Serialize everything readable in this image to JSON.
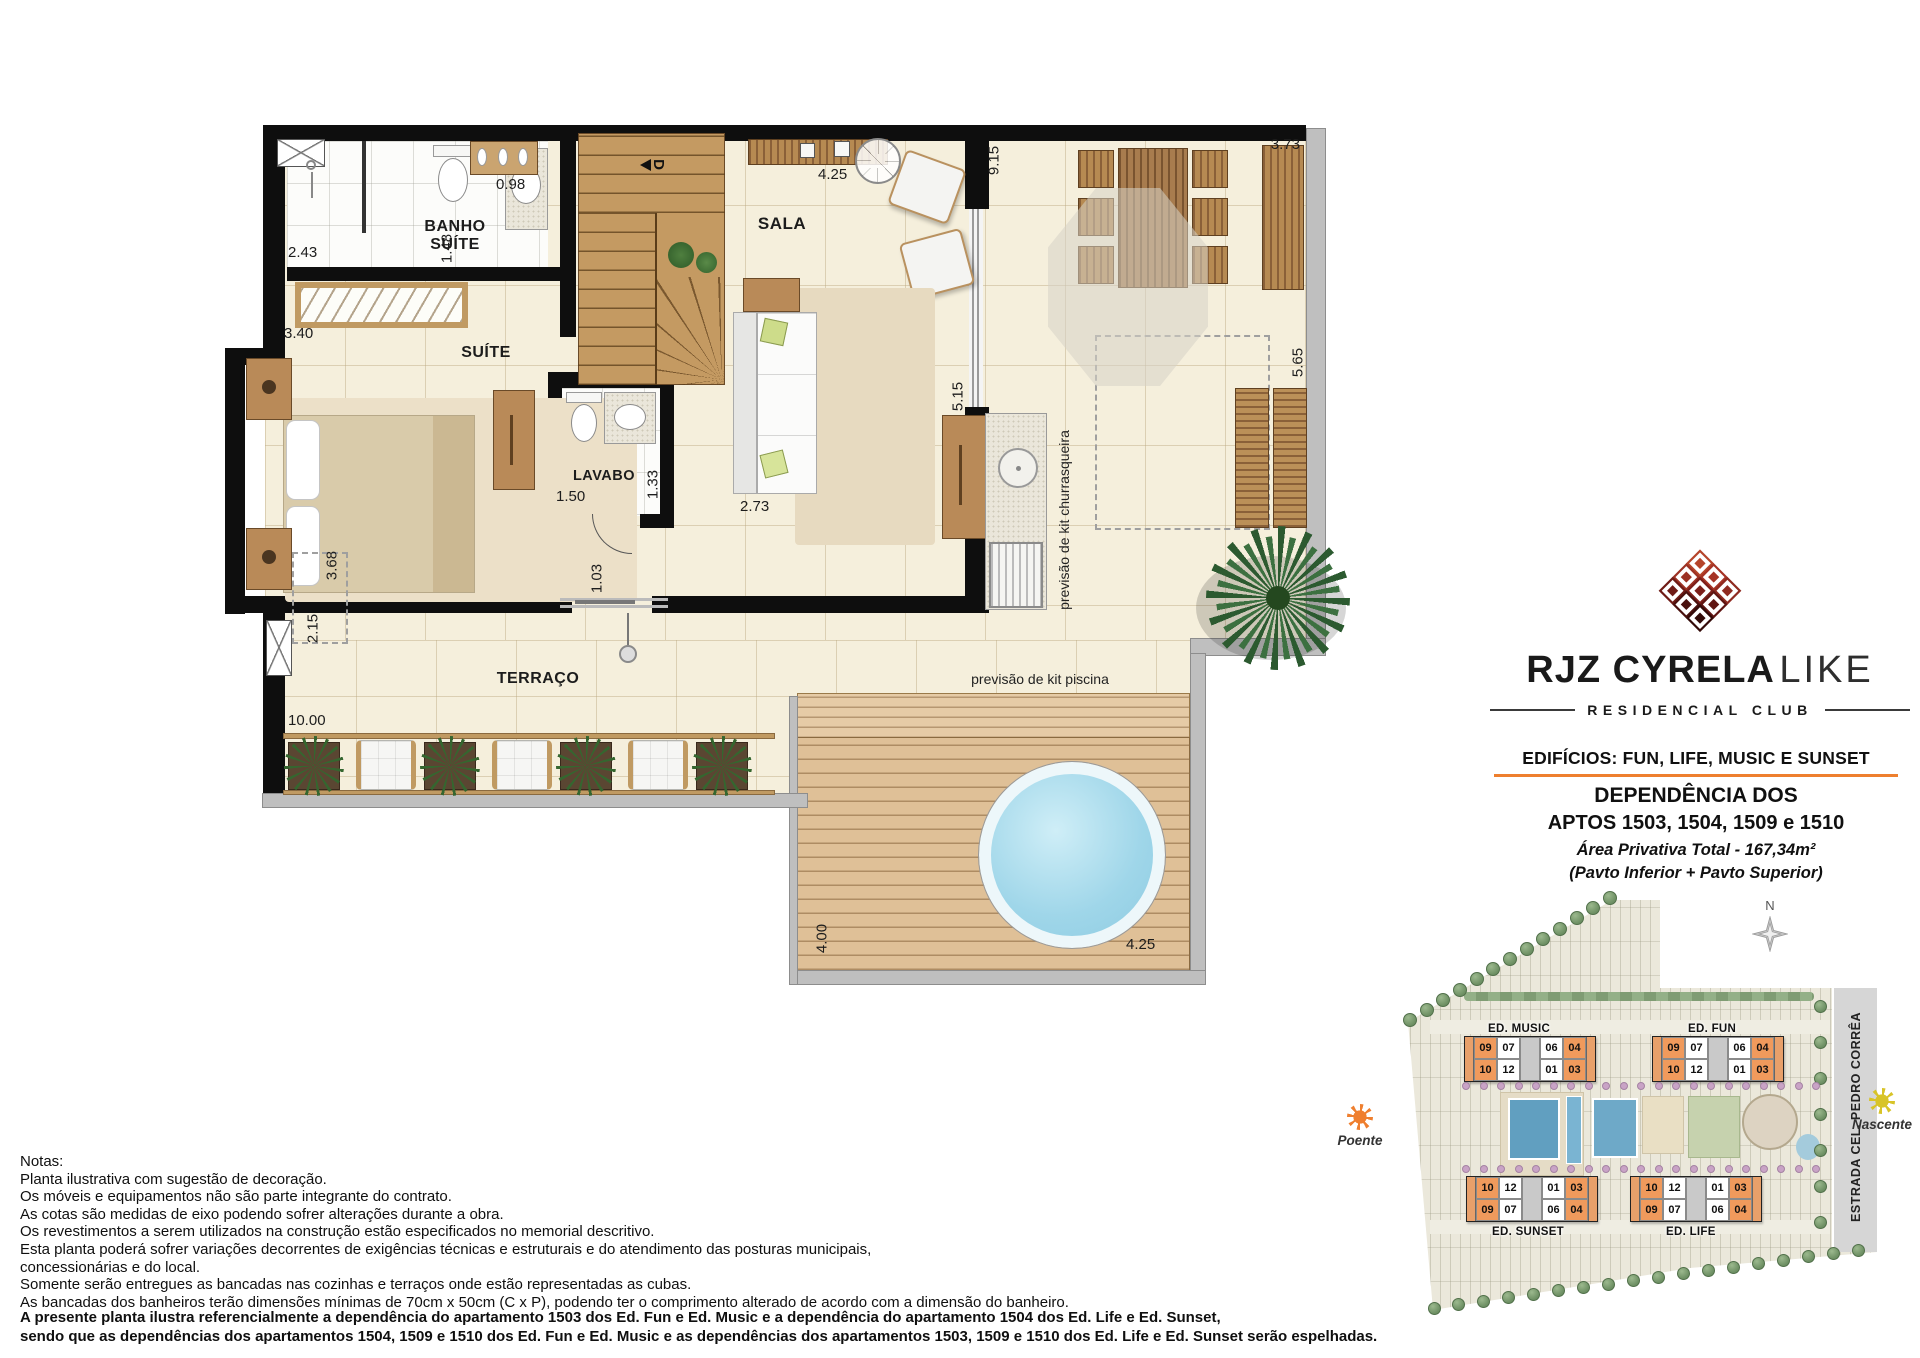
{
  "plan": {
    "rooms": {
      "banho": "BANHO SUÍTE",
      "suite": "SUÍTE",
      "sala": "SALA",
      "lavabo": "LAVABO",
      "terraco": "TERRAÇO"
    },
    "dims": {
      "shower": "2.43",
      "banho": "1.48",
      "shoe": "0.98",
      "closet": "3.40",
      "suite_wall": "3.68",
      "terr_left": "2.15",
      "terr_width": "10.00",
      "lav_w": "1.50",
      "lav_d": "1.33",
      "sofa": "2.73",
      "door": "1.03",
      "tv": "4.25",
      "terr_top": "9.15",
      "terr_mid": "5.15",
      "corner": "3.73",
      "right_side": "5.65",
      "deck_h": "4.00",
      "deck_w": "4.25"
    },
    "stairs_dir": "D",
    "annotations": {
      "churrasqueira": "previsão de kit churrasqueira",
      "piscina": "previsão de kit piscina"
    }
  },
  "brand": {
    "name": "RJZ CYRELA",
    "name_light": "LIKE",
    "subtitle": "RESIDENCIAL CLUB"
  },
  "info": {
    "edificios": "EDIFÍCIOS:  FUN, LIFE, MUSIC E SUNSET",
    "dep1": "DEPENDÊNCIA DOS",
    "dep2": "APTOS 1503, 1504, 1509 e 1510",
    "area": "Área Privativa Total - 167,34m²",
    "pavto": "(Pavto Inferior + Pavto Superior)"
  },
  "siteplan": {
    "compass": "N",
    "road": "ESTRADA CEL. PEDRO CORRÊA",
    "sun_west": "Poente",
    "sun_east": "Nascente",
    "buildings": [
      {
        "name": "ED. MUSIC",
        "rows": [
          [
            "09",
            "07",
            "06",
            "04"
          ],
          [
            "10",
            "12",
            "01",
            "03"
          ]
        ]
      },
      {
        "name": "ED. FUN",
        "rows": [
          [
            "09",
            "07",
            "06",
            "04"
          ],
          [
            "10",
            "12",
            "01",
            "03"
          ]
        ]
      },
      {
        "name": "ED. SUNSET",
        "rows": [
          [
            "10",
            "12",
            "01",
            "03"
          ],
          [
            "09",
            "07",
            "06",
            "04"
          ]
        ]
      },
      {
        "name": "ED. LIFE",
        "rows": [
          [
            "10",
            "12",
            "01",
            "03"
          ],
          [
            "09",
            "07",
            "06",
            "04"
          ]
        ]
      }
    ]
  },
  "notes": {
    "title": "Notas:",
    "lines": [
      "Planta ilustrativa com sugestão de decoração.",
      "Os móveis e equipamentos não são parte integrante do contrato.",
      "As cotas são medidas de eixo podendo sofrer alterações durante a obra.",
      "Os revestimentos a serem utilizados na construção estão especificados no memorial descritivo.",
      "Esta planta poderá sofrer variações decorrentes de exigências técnicas e estruturais e do atendimento das posturas municipais,",
      "concessionárias e do local.",
      "Somente serão entregues as bancadas nas cozinhas e terraços onde estão representadas as cubas.",
      "As bancadas dos banheiros terão dimensões mínimas de 70cm x 50cm (C x P), podendo ter o comprimento alterado de acordo com a dimensão do banheiro."
    ],
    "bold": [
      "A presente planta ilustra referencialmente a dependência do apartamento 1503 dos Ed. Fun e Ed. Music e a dependência do apartamento 1504 dos Ed. Life e Ed. Sunset,",
      "sendo que as dependências dos apartamentos 1504, 1509 e 1510 dos Ed. Fun e Ed. Music e as dependências dos apartamentos 1503, 1509 e 1510 dos Ed. Life e Ed. Sunset serão espelhadas."
    ]
  }
}
